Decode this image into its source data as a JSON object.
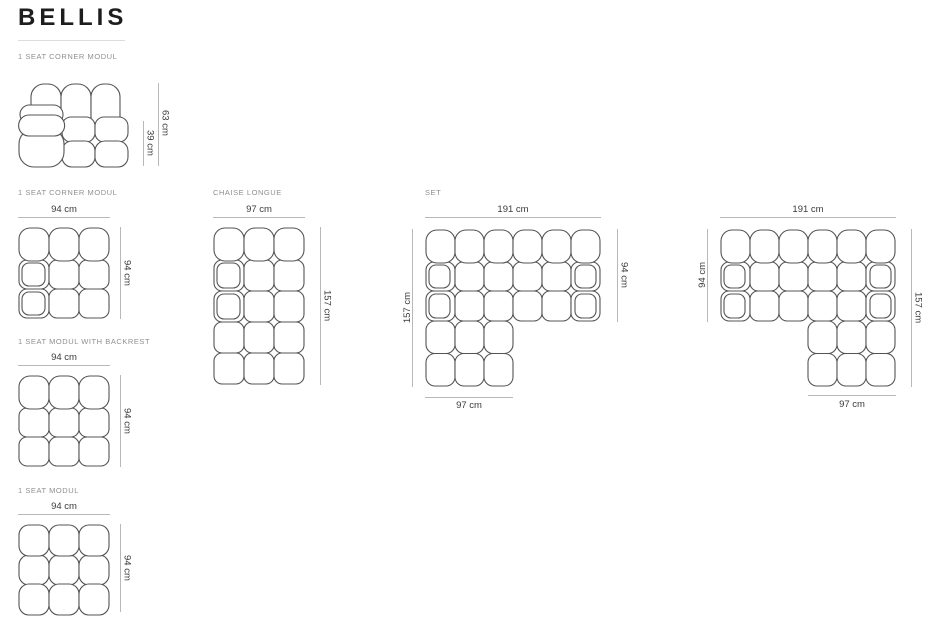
{
  "title": "BELLIS",
  "figures": {
    "corner_side": {
      "label": "1 SEAT CORNER MODUL",
      "total_height": "63 cm",
      "seat_height": "39 cm"
    },
    "corner_top": {
      "label": "1 SEAT CORNER MODUL",
      "width": "94 cm",
      "depth": "94 cm"
    },
    "backrest_module": {
      "label": "1 SEAT MODUL WITH BACKREST",
      "width": "94 cm",
      "depth": "94 cm"
    },
    "seat_module": {
      "label": "1 SEAT MODUL",
      "width": "94 cm",
      "depth": "94 cm"
    },
    "chaise_longue": {
      "label": "CHAISE LONGUE",
      "width": "97 cm",
      "depth": "157 cm"
    },
    "set_left": {
      "label": "SET",
      "total_width": "191 cm",
      "sofa_depth": "94 cm",
      "chaise_depth": "157 cm",
      "chaise_width": "97 cm"
    },
    "set_right": {
      "total_width": "191 cm",
      "sofa_depth": "94 cm",
      "chaise_depth": "157 cm",
      "chaise_width": "97 cm"
    }
  },
  "colors": {
    "sofa_outline": "#545454",
    "dimension_line": "#b8b8b8",
    "dimension_text": "#3a3a3a",
    "label_text": "#8f8f8f",
    "title_text": "#1d1d1d",
    "background": "#ffffff"
  }
}
